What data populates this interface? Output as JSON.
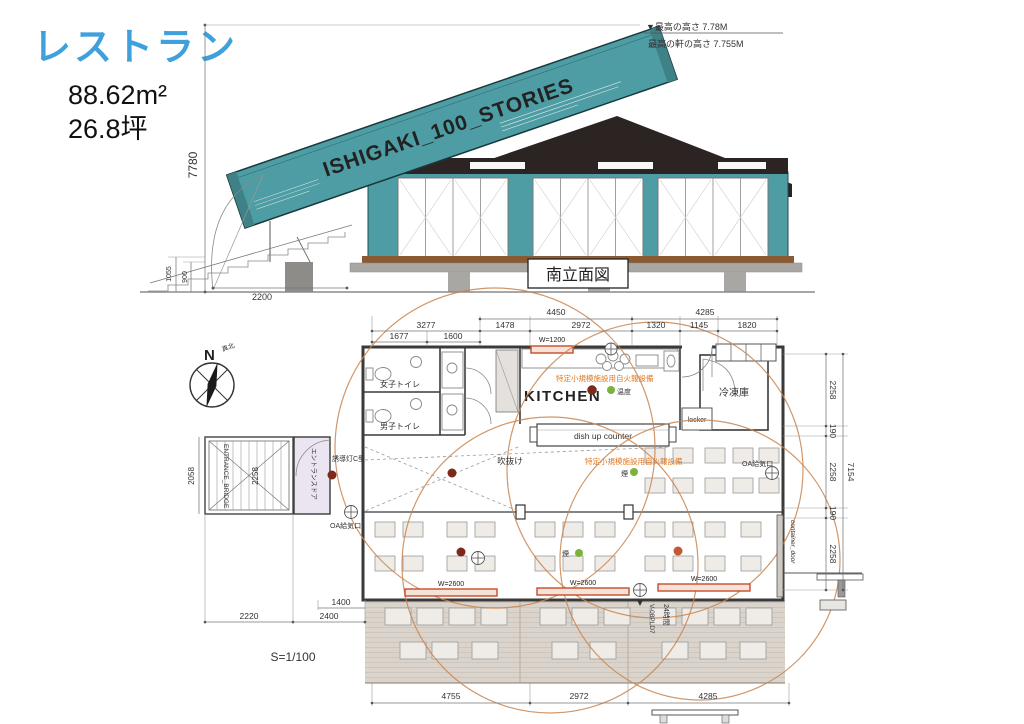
{
  "page": {
    "title": "レストラン",
    "area_m2": "88.62m²",
    "area_tsubo": "26.8坪"
  },
  "colors": {
    "accent_blue": "#3FA0DC",
    "container_teal": "#4F9DA4",
    "roof_dark": "#2B2422",
    "deck_brown": "#8A5A33",
    "fire_circle_orange": "#C9854F",
    "alarm_text_orange": "#E07820",
    "window_red": "#C64A2E",
    "sensor_green": "#7CB23E",
    "sensor_dark_red": "#7E2A1A"
  },
  "elevation": {
    "label": "南立面図",
    "container_text": "ISHIGAKI_100_STORIES",
    "note_max": "▼最高の高さ 7.78M",
    "note_eave": "最高の軒の高さ 7.755M",
    "dim_height": "7780",
    "dim_1055": "1055",
    "dim_900": "900",
    "dim_2200": "2200"
  },
  "plan": {
    "scale": "S=1/100",
    "compass": {
      "n": "N",
      "true_north": "真北"
    },
    "rooms": {
      "kitchen": "KITCHEN",
      "freezer": "冷凍庫",
      "wc_women": "女子トイレ",
      "wc_men": "男子トイレ",
      "locker": "locker",
      "void": "吹抜け",
      "bridge": "ENTRANCE_BRIDGE",
      "entrance_door": "エントランスドア",
      "container_door": "container_door",
      "dishup": "dish up counter"
    },
    "labels": {
      "alarm": "特定小規模施設用自火報設備",
      "heat": "温度",
      "smoke": "煙",
      "guide_light": "誘導灯C型",
      "oa_vent": "OA給気口",
      "fan": "V-08PLD7",
      "h24": "24時間",
      "w1200": "W=1200",
      "w2600": "W=2600"
    },
    "dims": {
      "top1": [
        "4450",
        "4285"
      ],
      "top2": [
        "3277",
        "1478",
        "2972",
        "1320",
        "1145",
        "1820"
      ],
      "top3": [
        "1677",
        "1600"
      ],
      "right": [
        "2258",
        "190",
        "2258",
        "190",
        "2258"
      ],
      "right_total": "7154",
      "left_outer": "2058",
      "bridge_dim": "2258",
      "b2220": "2220",
      "b1400": "1400",
      "b2400": "2400",
      "bottom": [
        "4755",
        "2972",
        "4285"
      ]
    }
  }
}
